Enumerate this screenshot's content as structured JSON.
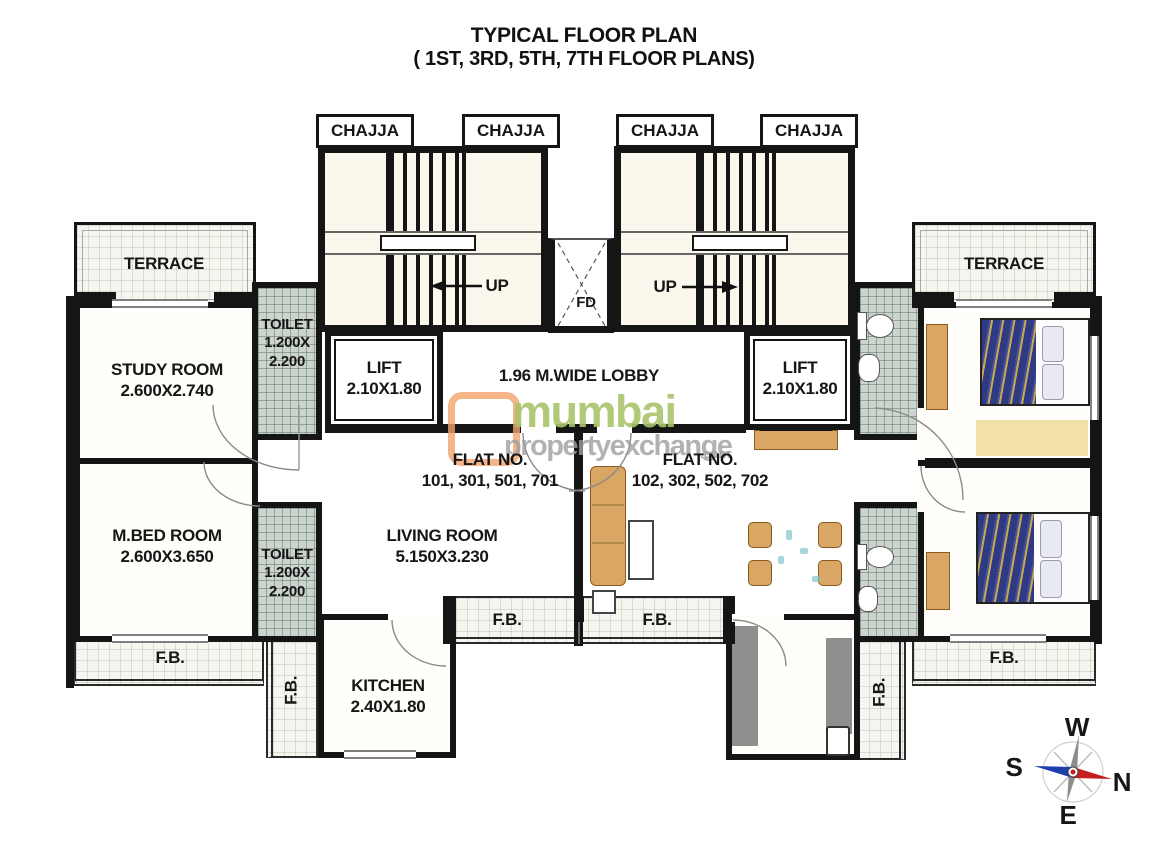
{
  "title": {
    "line1": "TYPICAL FLOOR PLAN",
    "line2": "( 1ST, 3RD, 5TH, 7TH FLOOR PLANS)"
  },
  "labels": {
    "chajja": "CHAJJA",
    "up": "UP",
    "fd": "FD",
    "lobby": "1.96 M.WIDE LOBBY",
    "lift_name": "LIFT",
    "lift_size": "2.10X1.80",
    "terrace": "TERRACE",
    "toilet_name": "TOILET",
    "toilet_size_a": "1.200X",
    "toilet_size_b": "2.200",
    "fb": "F.B."
  },
  "flats": {
    "left": {
      "heading": "FLAT NO.",
      "numbers": "101, 301, 501, 701"
    },
    "right": {
      "heading": "FLAT NO.",
      "numbers": "102, 302, 502, 702"
    }
  },
  "rooms": {
    "study": {
      "name": "STUDY ROOM",
      "size": "2.600X2.740"
    },
    "master_bedroom": {
      "name": "M.BED ROOM",
      "size": "2.600X3.650"
    },
    "living": {
      "name": "LIVING ROOM",
      "size": "5.150X3.230"
    },
    "kitchen": {
      "name": "KITCHEN",
      "size": "2.40X1.80"
    }
  },
  "compass": {
    "west": "W",
    "south": "S",
    "north": "N",
    "east": "E"
  },
  "watermark": {
    "word1": "mumbai",
    "word2": "propertyexchange",
    "tld": ".com"
  },
  "colors": {
    "wall": "#151515",
    "tile": "#ccd4ce",
    "furniture_wood": "#d9a763",
    "bed_navy": "#2f3a85",
    "counter_gray": "#8f8f8f",
    "watermark_orange": "#f1a26b",
    "watermark_green": "#a9c46a",
    "watermark_gray": "#9f9f9f",
    "compass_red": "#c41f1f",
    "compass_blue": "#1d3fae"
  }
}
